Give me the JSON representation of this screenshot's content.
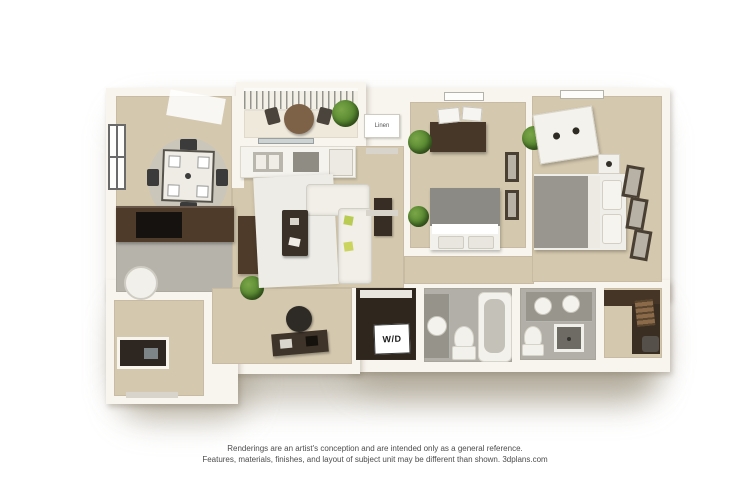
{
  "footer": {
    "line1": "Renderings are an artist's conception and are intended only as a general reference.",
    "line2": "Features, materials, finishes, and layout of subject unit may be different than shown.  3dplans.com"
  },
  "labels": {
    "washer_dryer": "W/D",
    "linen": "Linen"
  },
  "colors": {
    "wall": "#f8f5ee",
    "carpet": "#d4c8ae",
    "hard_floor": "#b6b3ab",
    "bath_floor": "#b2afa8",
    "closet_floor": "#2f261d",
    "dark_wood": "#4e3b2a",
    "rug": "#edece7",
    "comforter_gray": "#98968f",
    "plant_green": "#55862f",
    "pillow_green": "#b9cb52",
    "shadow": "rgba(150,140,118,0.5)"
  }
}
